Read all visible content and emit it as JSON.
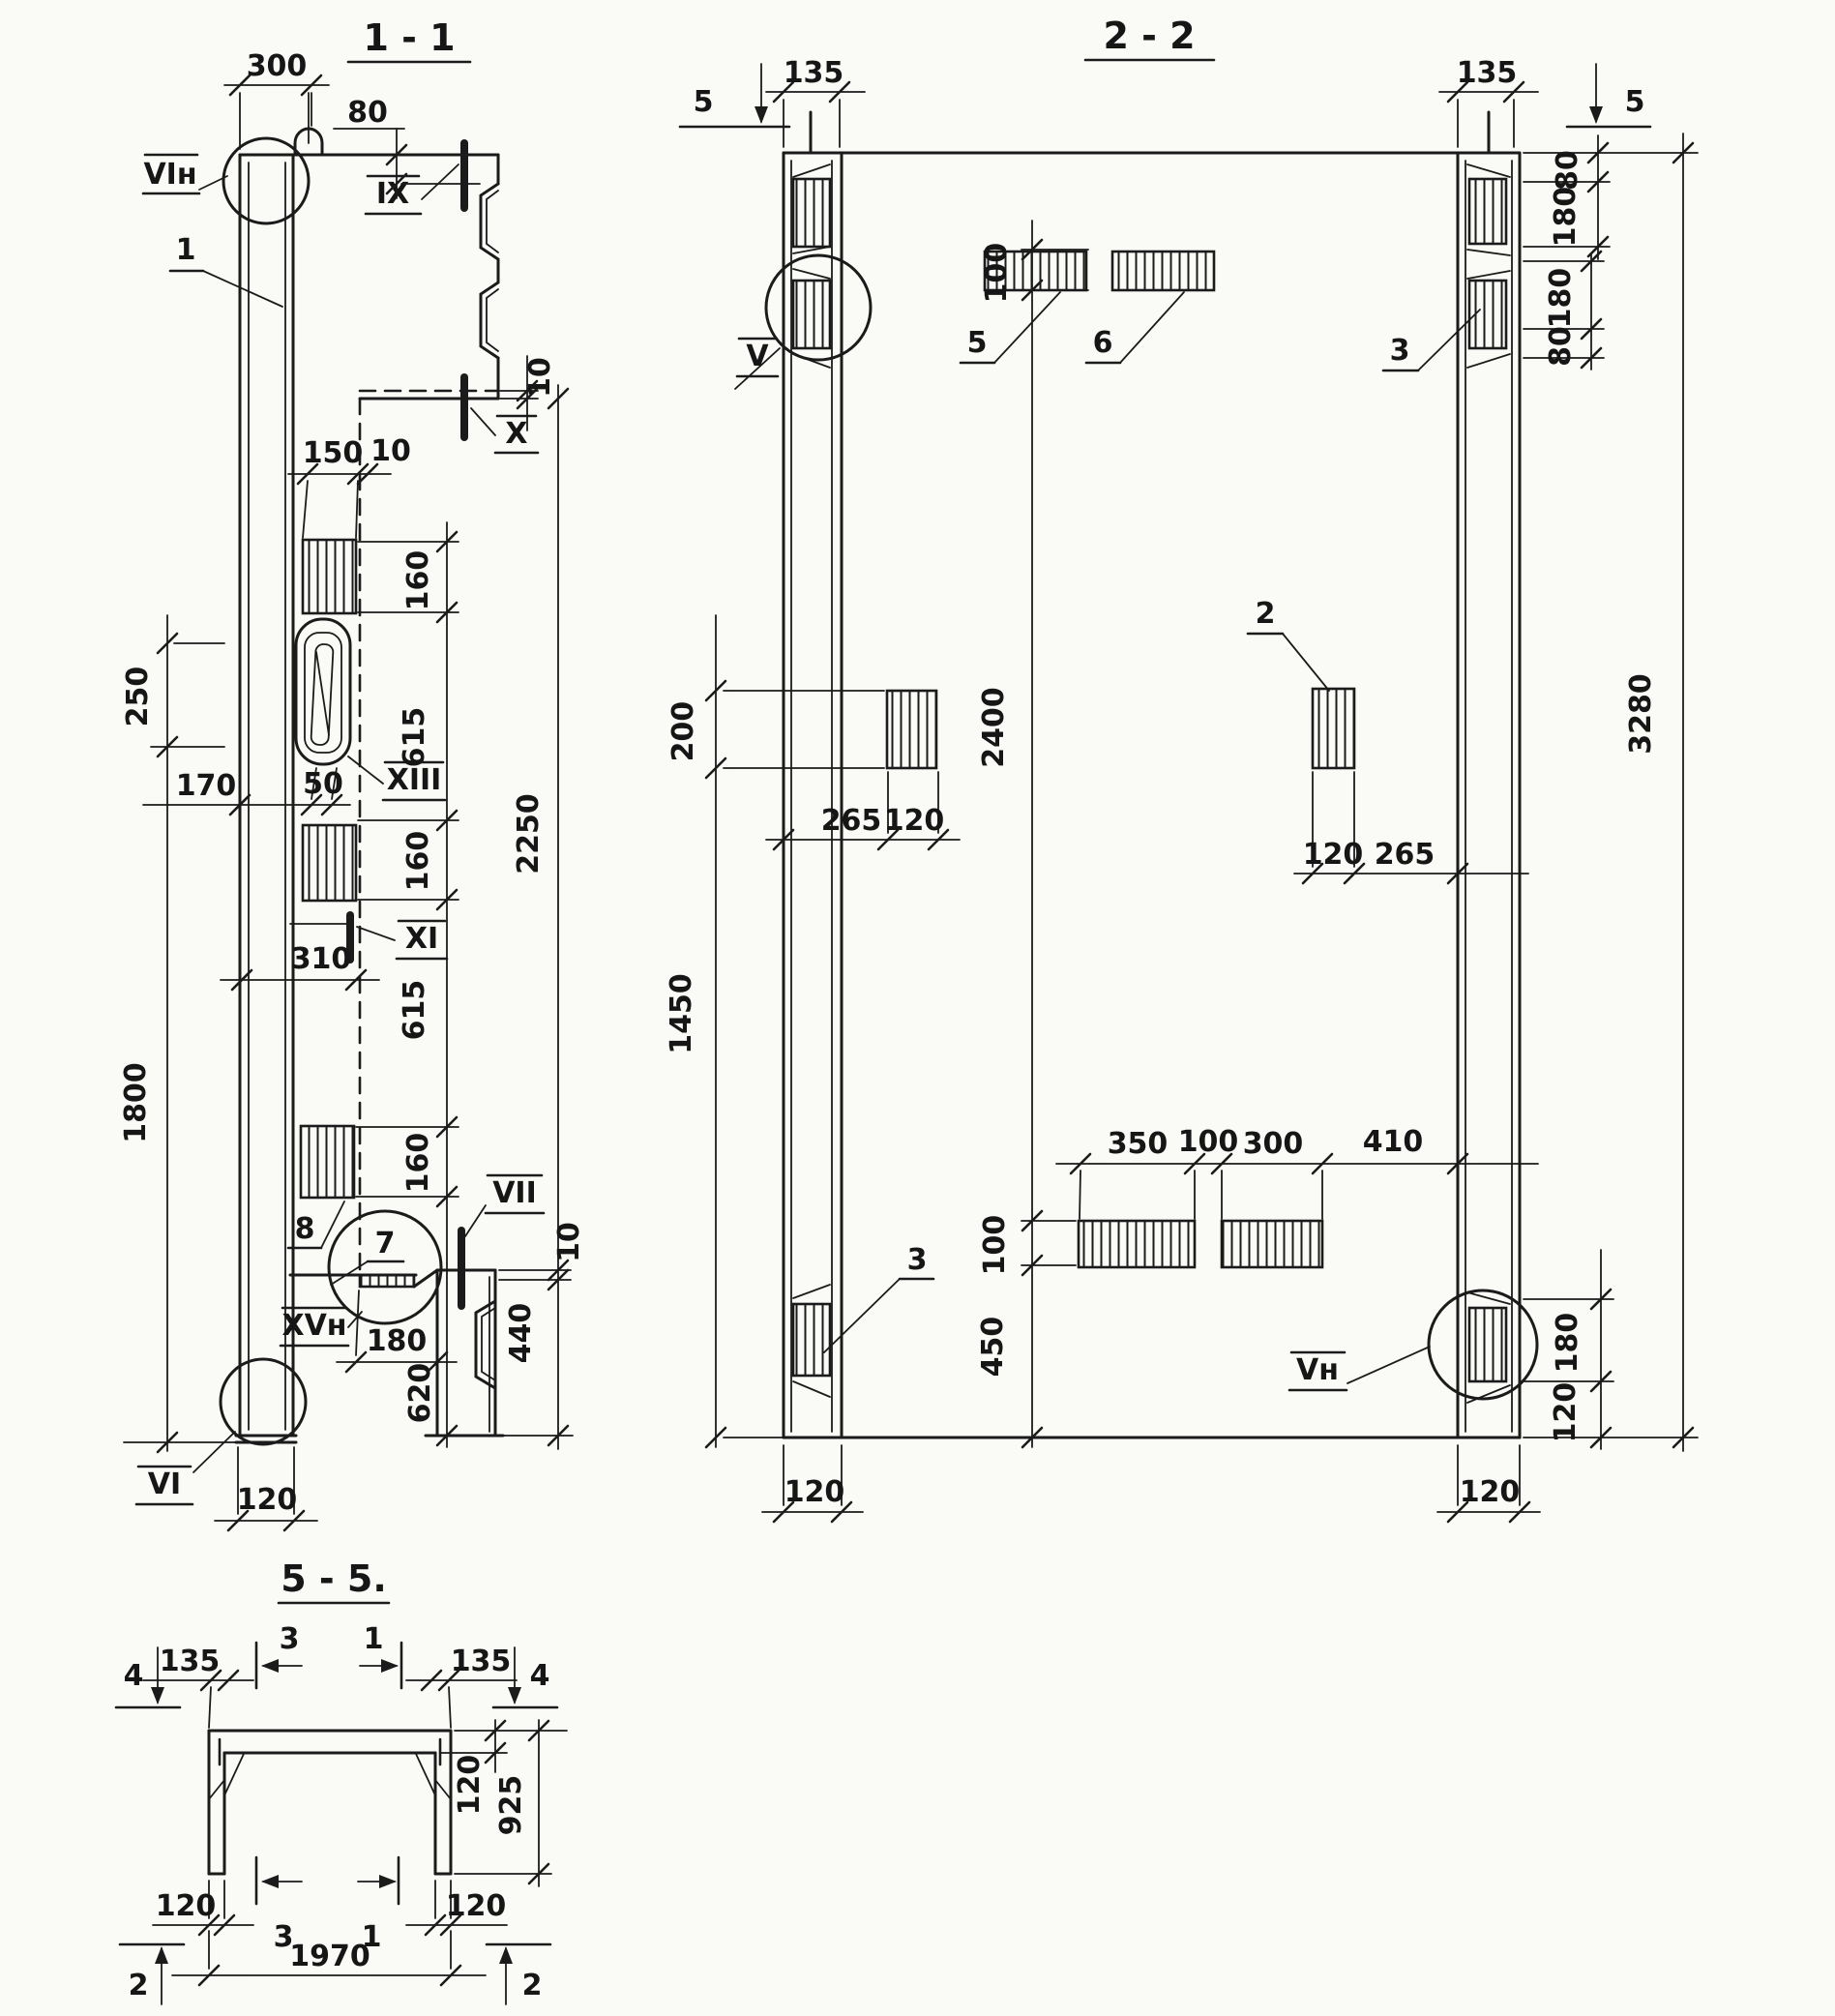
{
  "drawing": {
    "s11": {
      "title": "1 - 1",
      "dims": {
        "d300": "300",
        "d80": "80",
        "d10top": "10",
        "d150": "150",
        "d10web": "10",
        "c160a": "160",
        "c615a": "615",
        "c160b": "160",
        "c615b": "615",
        "c160c": "160",
        "c620": "620",
        "d2250": "2250",
        "d10bot": "10",
        "d440": "440",
        "d250": "250",
        "d1800": "1800",
        "d170": "170",
        "d50": "50",
        "d310": "310",
        "d180": "180",
        "d120": "120"
      },
      "callouts": {
        "vin": "VIн",
        "n1": "1",
        "ix": "IX",
        "x": "X",
        "xiii": "XIII",
        "xi": "XI",
        "vii": "VII",
        "xvn": "XVн",
        "n7": "7",
        "n8": "8",
        "vi": "VI"
      }
    },
    "s22": {
      "title": "2 - 2",
      "dims": {
        "d135l": "135",
        "d135r": "135",
        "d80a": "80",
        "d180a": "180",
        "d180b": "180",
        "d80b": "80",
        "d3280": "3280",
        "d100top": "100",
        "d2400": "2400",
        "d100bot": "100",
        "d450": "450",
        "d200": "200",
        "d1450": "1450",
        "d265l": "265",
        "d120l": "120",
        "d120r": "120",
        "d265r": "265",
        "d350": "350",
        "d100mid": "100",
        "d300": "300",
        "d410": "410",
        "d180c": "180",
        "d120c": "120",
        "d120bl": "120",
        "d120br": "120"
      },
      "callouts": {
        "v": "V",
        "vn": "Vн",
        "n2": "2",
        "n3tr": "3",
        "n3bl": "3",
        "n5": "5",
        "n6": "6",
        "mark5l": "5",
        "mark5r": "5"
      }
    },
    "s55": {
      "title": "5 - 5.",
      "dims": {
        "d135l": "135",
        "d135r": "135",
        "d120slab": "120",
        "d925": "925",
        "d120bl": "120",
        "d120br": "120",
        "d1970": "1970"
      },
      "callouts": {
        "m3top": "3",
        "m1top": "1",
        "m3bot": "3",
        "m1bot": "1",
        "m4l": "4",
        "m4r": "4",
        "m2l": "2",
        "m2r": "2"
      }
    }
  }
}
